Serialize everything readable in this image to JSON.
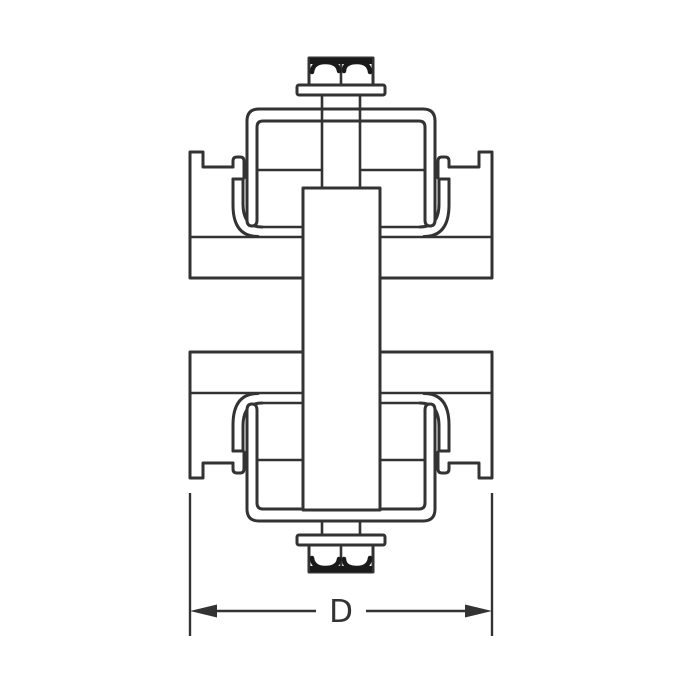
{
  "diagram": {
    "kind": "strut-channel-clamp-cross-section",
    "dimension": {
      "label": "D",
      "measured_span": "outer width of channel (left wall to right wall)"
    },
    "parts": [
      "hex-bolt-head",
      "flat-washer",
      "threaded-rod",
      "clamp-strap",
      "strut-channel-upper",
      "strut-channel-lower",
      "saddle-insert",
      "center-plate",
      "hex-nut"
    ],
    "colors": {
      "line": "#333333",
      "shading": "#1a1a1a",
      "background": "#ffffff"
    }
  }
}
